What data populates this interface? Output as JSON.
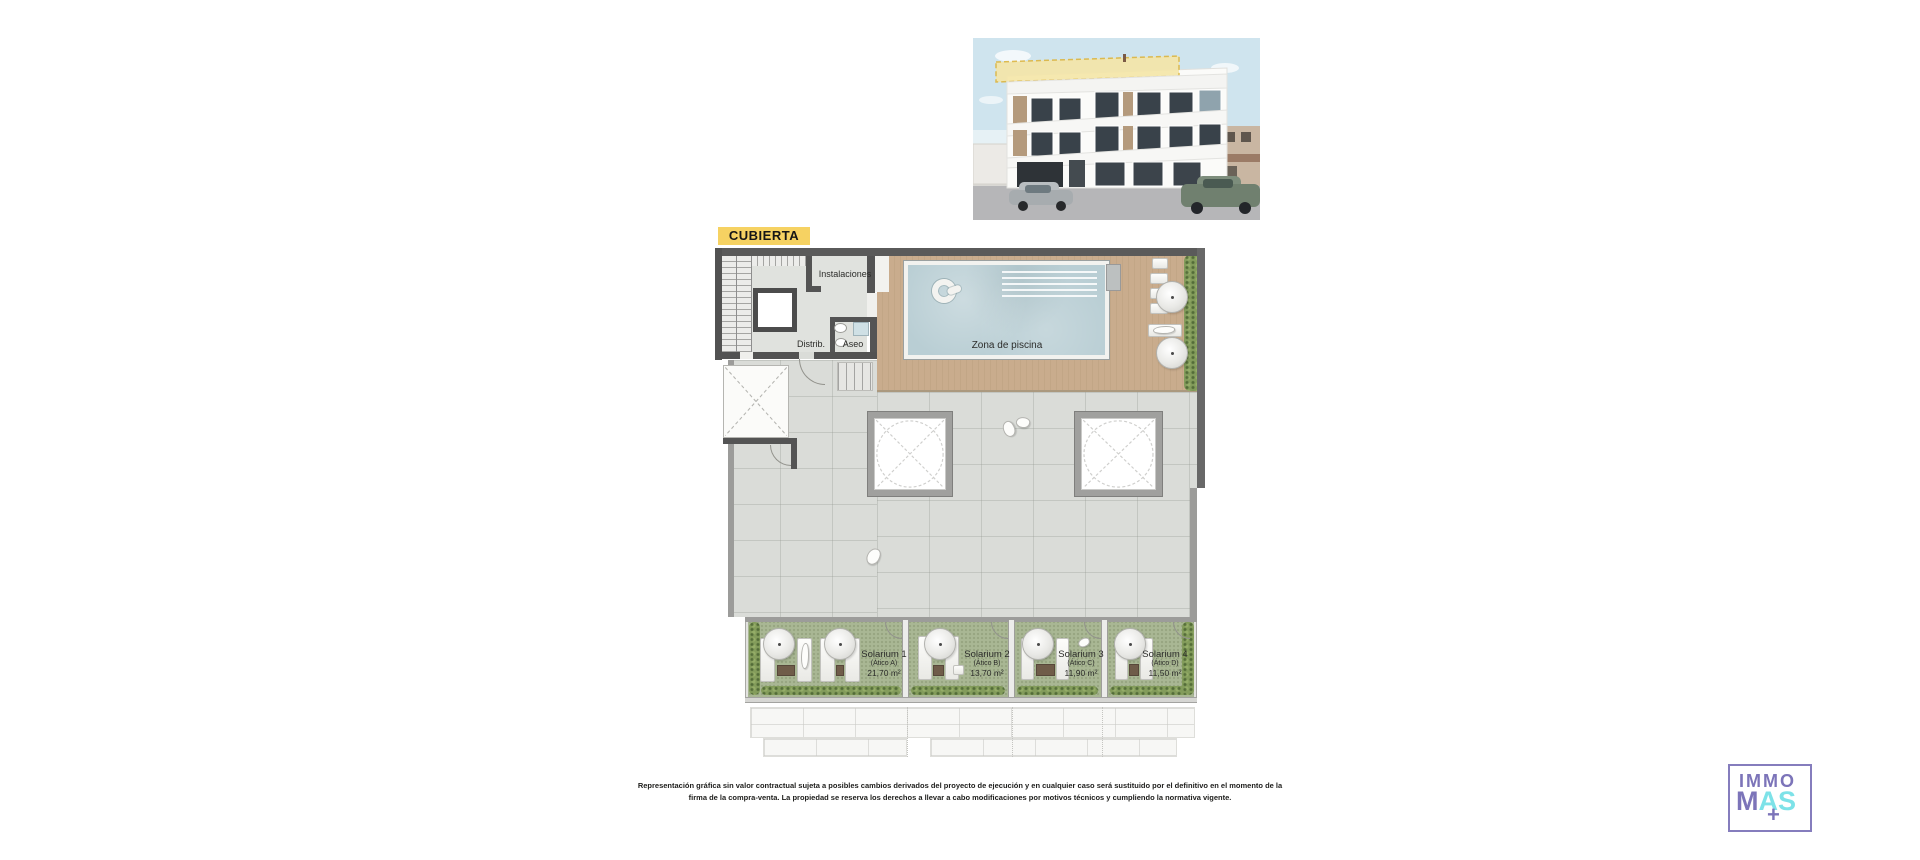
{
  "plan": {
    "title": "CUBIERTA",
    "labels": {
      "instalaciones": "Instalaciones",
      "distrib": "Distrib.",
      "aseo": "Aseo",
      "pool_area": "Zona de piscina"
    },
    "solariums": [
      {
        "name": "Solarium 1",
        "unit": "(Ático A)",
        "area": "21,70 m²"
      },
      {
        "name": "Solarium 2",
        "unit": "(Ático B)",
        "area": "13,70 m²"
      },
      {
        "name": "Solarium 3",
        "unit": "(Ático C)",
        "area": "11,90 m²"
      },
      {
        "name": "Solarium 4",
        "unit": "(Ático D)",
        "area": "11,50 m²"
      }
    ]
  },
  "disclaimer": {
    "line1": "Representación gráfica sin valor contractual sujeta a posibles cambios derivados del proyecto de ejecución y en cualquier caso será sustituido por el definitivo en el momento de la",
    "line2": "firma de la compra-venta. La propiedad se reserva los derechos a llevar a cabo modificaciones por motivos técnicos y cumpliendo la normativa vigente."
  },
  "logo": {
    "top": "IMMO",
    "m": "M",
    "a": "A",
    "s": "S",
    "plus": "+"
  },
  "colors": {
    "highlight_yellow": "#f6d262",
    "logo_purple": "#7c74b9",
    "logo_cyan": "#7de2e8",
    "pool_blue": "#b9ced4",
    "deck_wood": "#c7ab8b",
    "turf_green": "#a9b794",
    "wall_gray": "#545454"
  }
}
